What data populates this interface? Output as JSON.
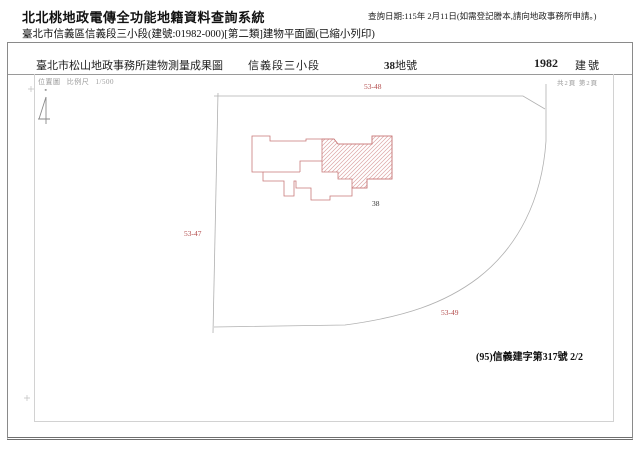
{
  "header_bar": {
    "system_title": "北北桃地政電傳全功能地籍資料查詢系統",
    "query_date": "查詢日期:115年 2月11日(如需登記謄本,請向地政事務所申請。)",
    "doc_subtitle": "臺北市信義區信義段三小段(建號:01982-000)[第二類]建物平面圖(已縮小列印)"
  },
  "form": {
    "title_row": {
      "office_title": "臺北市松山地政事務所建物測量成果圖",
      "section": "信義段三小段",
      "land_no": "38",
      "land_no_unit": "地號",
      "building_no": "1982",
      "building_no_unit": "建號"
    },
    "page_info": "共2頁 第2頁",
    "map": {
      "location_label": "位置圖",
      "scale_label": "比例尺",
      "scale_value": "1/500",
      "label_top": "53-48",
      "label_left": "53-47",
      "label_bottom": "53-49",
      "lot_label": "38"
    },
    "certificate_no": "(95)信義建字第317號 2/2",
    "colors": {
      "building_outline": "#c97a7a",
      "building_hatch": "#dca4a4",
      "parcel_line": "#b0b0b0",
      "red_label": "#b24a4a"
    }
  }
}
